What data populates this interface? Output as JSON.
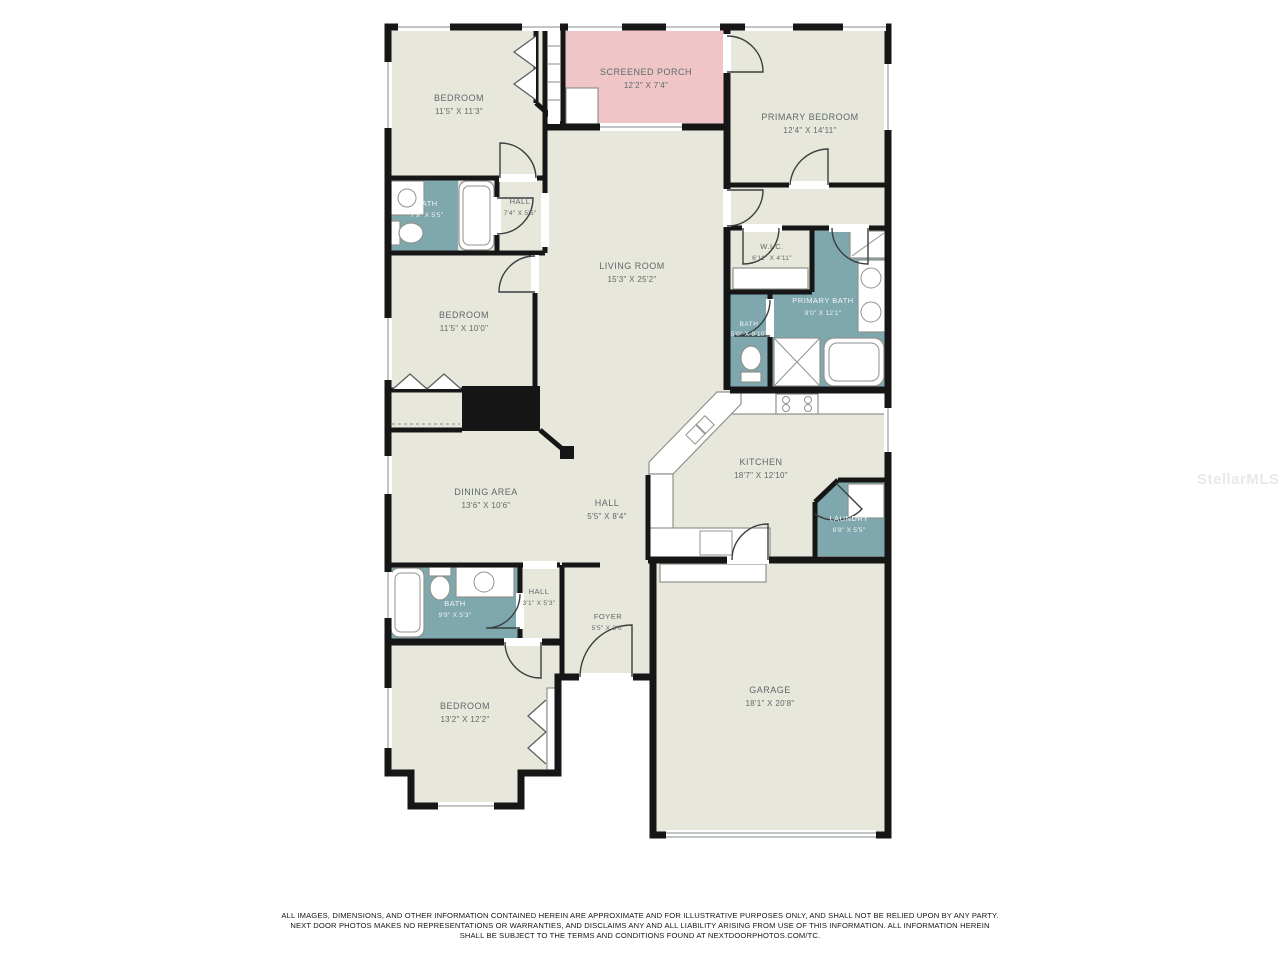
{
  "colors": {
    "background": "#ffffff",
    "room-fill": "#e8e7dc",
    "porch-fill": "#efc5c8",
    "wet-room-fill": "#7fa7ae",
    "wall": "#161616",
    "label": "#5d6a6a",
    "label-light": "#f1f5f4"
  },
  "watermark": "StellarMLS",
  "disclaimer": [
    "ALL IMAGES, DIMENSIONS, AND OTHER INFORMATION CONTAINED HEREIN ARE APPROXIMATE AND FOR ILLUSTRATIVE PURPOSES ONLY, AND SHALL NOT BE RELIED UPON BY ANY PARTY.",
    "NEXT DOOR PHOTOS MAKES NO REPRESENTATIONS OR WARRANTIES, AND DISCLAIMS ANY AND ALL LIABILITY ARISING FROM USE OF THIS INFORMATION. ALL INFORMATION HEREIN",
    "SHALL BE SUBJECT TO THE TERMS AND CONDITIONS FOUND AT NEXTDOORPHOTOS.COM/TC."
  ],
  "rooms": [
    {
      "name": "BEDROOM",
      "dims": "11'5\" X 11'3\""
    },
    {
      "name": "SCREENED PORCH",
      "dims": "12'2\" X 7'4\""
    },
    {
      "name": "PRIMARY BEDROOM",
      "dims": "12'4\" X 14'11\""
    },
    {
      "name": "BATH",
      "dims": "7'9\" X 5'5\""
    },
    {
      "name": "HALL",
      "dims": "7'4\" X 5'5\""
    },
    {
      "name": "LIVING ROOM",
      "dims": "15'3\" X 25'2\""
    },
    {
      "name": "W.I.C.",
      "dims": "6'11\" X 4'11\""
    },
    {
      "name": "PRIMARY BATH",
      "dims": "9'0\" X 12'1\""
    },
    {
      "name": "BATH",
      "dims": "5'0\" X 9'10\""
    },
    {
      "name": "BEDROOM",
      "dims": "11'5\" X 10'0\""
    },
    {
      "name": "KITCHEN",
      "dims": "18'7\" X 12'10\""
    },
    {
      "name": "LAUNDRY",
      "dims": "6'8\" X 5'5\""
    },
    {
      "name": "DINING AREA",
      "dims": "13'6\" X 10'6\""
    },
    {
      "name": "HALL",
      "dims": "5'5\" X 8'4\""
    },
    {
      "name": "BATH",
      "dims": "9'9\" X 5'3\""
    },
    {
      "name": "HALL",
      "dims": "3'1\" X 5'3\""
    },
    {
      "name": "FOYER",
      "dims": "5'5\" X 8'0\""
    },
    {
      "name": "BEDROOM",
      "dims": "13'2\" X 12'2\""
    },
    {
      "name": "GARAGE",
      "dims": "18'1\" X 20'8\""
    }
  ]
}
